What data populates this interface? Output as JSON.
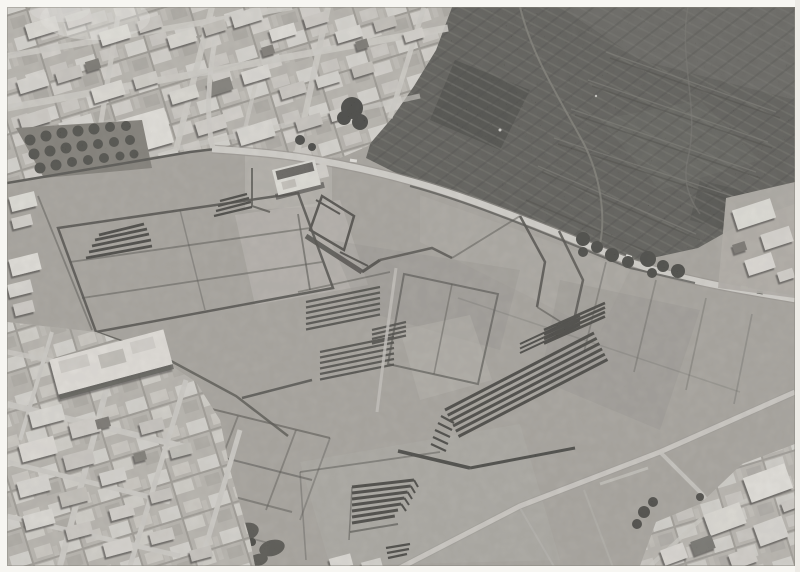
{
  "image": {
    "kind": "black-and-white aerial photograph",
    "description": "Black-and-white aerial photograph of a large terraced archaeological site with long stepped stone pyramids and walled rectangular field enclosures, bordered by a dense whitewashed town at the top-left and bottom-left, a dark terraced hillside in the upper right, a pale curving road separating town, site and hillside, a farm track crossing the lower fields, and a small cluster of white houses in the bottom-right corner. The print has a white photo border."
  },
  "scene": {
    "regions": [
      {
        "name": "upper-town",
        "label": "dense white village blocks on diagonal streets"
      },
      {
        "name": "orchard",
        "label": "dark orchard trees beside the upper town"
      },
      {
        "name": "hillside-terraces",
        "label": "dark terraced hillside slope"
      },
      {
        "name": "main-road",
        "label": "light curving road with small vehicles"
      },
      {
        "name": "site-grounds",
        "label": "open grounds with low stone walls forming enclosures"
      },
      {
        "name": "stepped-pyramids",
        "label": "stepped pyramid platforms with parallel terrace walls"
      },
      {
        "name": "central-building",
        "label": "white flat-roofed building inside the site"
      },
      {
        "name": "farm-track",
        "label": "pale track crossing the lower fields"
      },
      {
        "name": "lower-town",
        "label": "white town blocks bottom-left"
      },
      {
        "name": "corner-houses",
        "label": "white houses in bottom-right corner"
      }
    ]
  },
  "palette": {
    "photo_border": "#f7f6f2",
    "ground": "#a7a39b",
    "ground_light": "#c1bdb5",
    "hillside": "#4c4b45",
    "walls": "#3a3833",
    "white_roofs": "#eeebe4",
    "road": "#dcd9d2",
    "trees": "#33322d"
  }
}
